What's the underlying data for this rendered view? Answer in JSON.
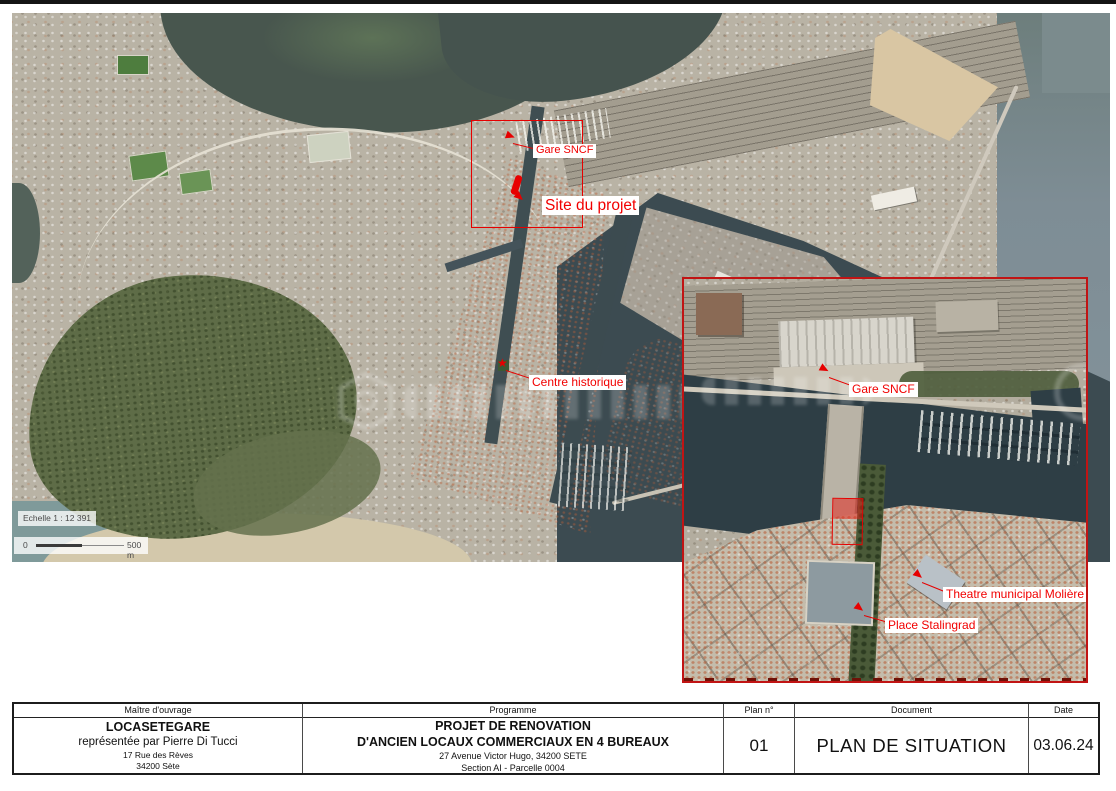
{
  "colors": {
    "annotation_red": "#f10000",
    "marker_red": "#e60000",
    "inset_border_red": "#c11414",
    "water_dark": "#3c4b51",
    "water_lagoon": "#48564e",
    "sea_haze": "#83949c",
    "land_base": "#b9b3a5",
    "hill_green": "#5e6c47",
    "sand": "#d9c6a3"
  },
  "main_map": {
    "labels": {
      "gare_sncf": "Gare SNCF",
      "site_du_projet": "Site du projet",
      "centre_historique": "Centre historique"
    },
    "scale": {
      "echelle": "Echelle 1 : 12 391",
      "bar_start": "0",
      "bar_end": "500 m"
    }
  },
  "inset_map": {
    "labels": {
      "gare_sncf": "Gare SNCF",
      "theatre": "Theatre municipal Molière",
      "place_stalingrad": "Place Stalingrad"
    }
  },
  "title_block": {
    "maitre": {
      "header": "Maître d'ouvrage",
      "name": "LOCASETEGARE",
      "line2": "représentée par Pierre Di Tucci",
      "line3": "17 Rue des Rèves",
      "line4": "34200 Sète"
    },
    "programme": {
      "header": "Programme",
      "line1": "PROJET DE RENOVATION",
      "line2": "D'ANCIEN LOCAUX COMMERCIAUX EN 4 BUREAUX",
      "line3": "27 Avenue Victor Hugo, 34200 SETE",
      "line4": "Section AI - Parcelle 0004"
    },
    "plan_no": {
      "header": "Plan n°",
      "value": "01"
    },
    "document": {
      "header": "Document",
      "value": "PLAN DE SITUATION"
    },
    "date": {
      "header": "Date",
      "value": "03.06.24"
    }
  }
}
